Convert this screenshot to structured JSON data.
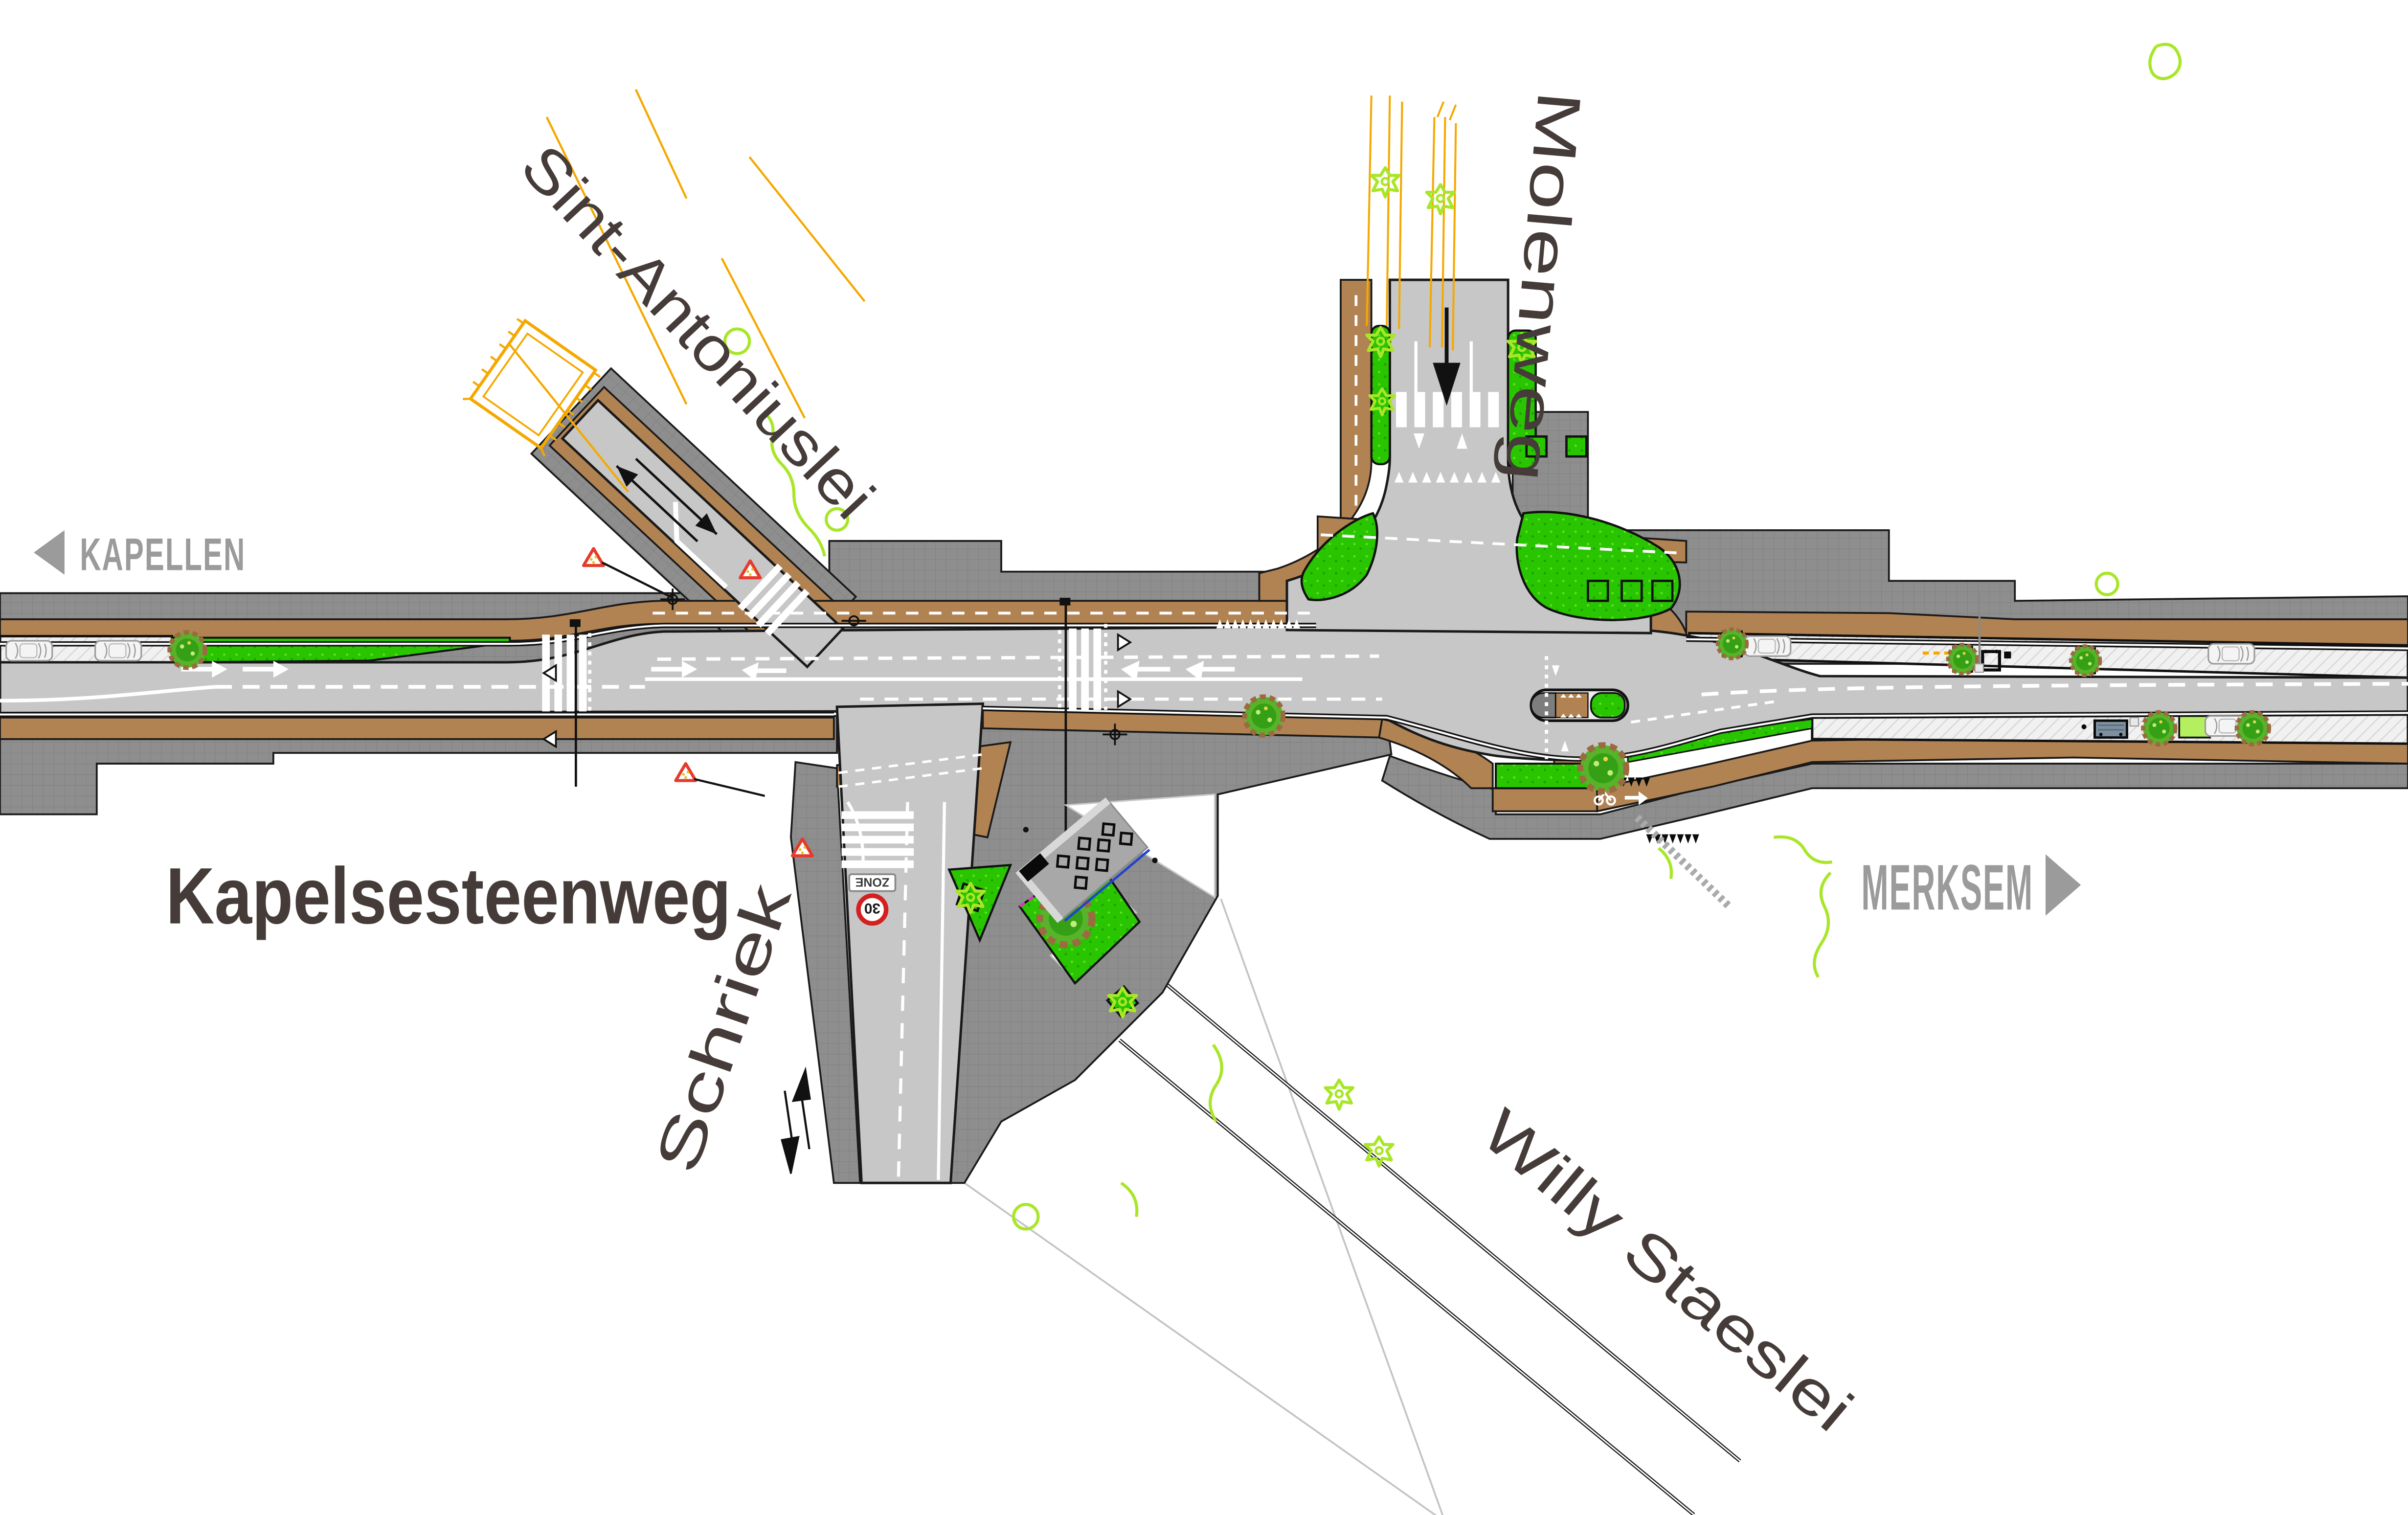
{
  "labels": {
    "kapellen": "KAPELLEN",
    "merksem": "MERKSEM",
    "kapelsesteenweg": "Kapelsesteenweg",
    "sint_antoniuslei": "Sint-Antoniuslei",
    "molenweg": "Molenweg",
    "schriek": "Schriek",
    "willy_staeslei": "Willy Staeslei",
    "zone": "ZONE",
    "speed_30": "30"
  },
  "plan": {
    "type": "road redesign plan / street map",
    "main_street": "Kapelsesteenweg",
    "side_streets": [
      "Sint-Antoniuslei",
      "Molenweg",
      "Schriek",
      "Willy Staeslei"
    ],
    "direction_west": "KAPELLEN",
    "direction_east": "MERKSEM",
    "features": [
      "cycle-paths-both-sides",
      "zebra-crossings",
      "pedestrian-refuge-island",
      "bus-shelter",
      "bike-parking-shelter",
      "parking-bays-with-trees",
      "green-verges",
      "one-way-molenweg",
      "two-way-schriek",
      "zone-30-sign",
      "yield-shark-teeth",
      "warning-triangles",
      "survey-lines"
    ]
  },
  "colors": {
    "asphalt": "#c7c7c7",
    "sidewalk": "#8e8e8e",
    "cycle_path_brown": "#b28352",
    "grass_green": "#29c501",
    "light_green": "#b4ef5f",
    "vegetation_outline": "#a9e629",
    "survey_yellow": "#f5a800",
    "label_dark": "#453c39",
    "label_gray": "#9b9b9b",
    "warning_red": "#e53b2c",
    "zone30_red": "#d42020",
    "shelter_blue": "#7e90a0",
    "magenta_line": "#e22ecc",
    "blue_line": "#2244cc"
  },
  "icons": [
    "tree-icon",
    "planter-tree-icon",
    "car-icon",
    "bus-shelter-icon",
    "bike-parking-icon",
    "warning-triangle-icon",
    "traffic-light-mast-icon",
    "zebra-crossing",
    "yield-teeth-marking",
    "one-way-arrow-icon",
    "two-way-arrow-icon",
    "direction-arrow-west-icon",
    "direction-arrow-east-icon",
    "bicycle-marking-icon",
    "zone30-sign"
  ]
}
